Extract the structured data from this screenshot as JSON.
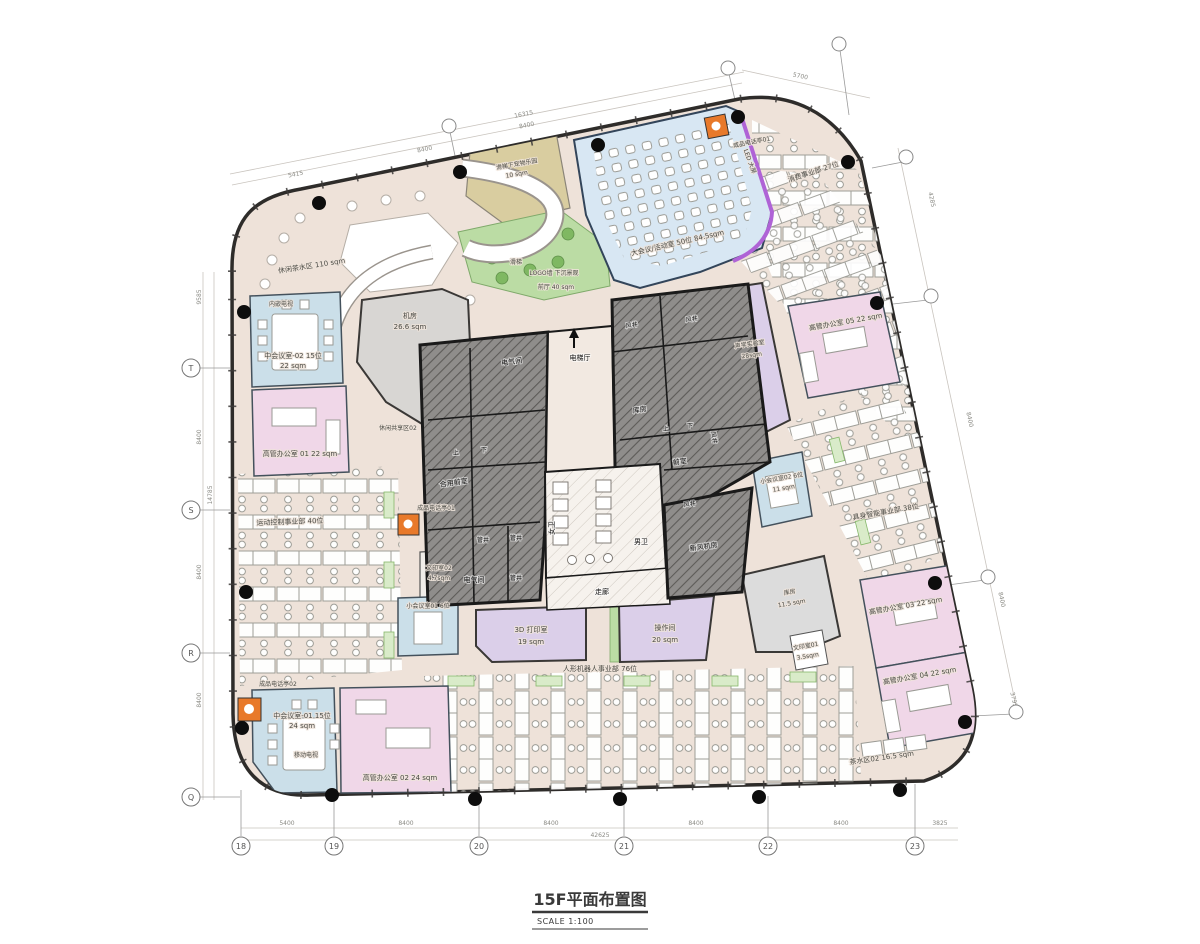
{
  "title": {
    "main": "15F平面布置图",
    "scale": "SCALE 1:100"
  },
  "grid": {
    "left": [
      "T",
      "S",
      "R",
      "Q"
    ],
    "bottom": [
      "18",
      "19",
      "20",
      "21",
      "22",
      "23"
    ]
  },
  "dims": {
    "top": [
      "5415",
      "8400",
      "16315",
      "8400",
      "5700"
    ],
    "left": [
      "9585",
      "8400",
      "14785",
      "8400",
      "8400"
    ],
    "right": [
      "4285",
      "8400",
      "8400",
      "3795"
    ],
    "bottom": [
      "5400",
      "8400",
      "8400",
      "8400",
      "8400",
      "3825",
      "42625"
    ]
  },
  "rooms": {
    "lounge_tea": "休闲茶水区 110 sqm",
    "pet_park": [
      "滑梯下宠物乐园",
      "10 sqm"
    ],
    "slide": "滑梯",
    "logo_wall": "LOGO墙 下沉景观",
    "front_hall": "前厅 40 sqm",
    "big_meeting": "大会议/活动室 50位 84.5sqm",
    "led_screen": "LED 大屏",
    "phone_booth_01a": "成品电话亭01",
    "consumer_dept": "消费事业部 27位",
    "embed_tv": "内嵌电视",
    "mid_meeting_02": [
      "中会议室-02 15位",
      "22 sqm"
    ],
    "exec_office_01": "高管办公室 01 22 sqm",
    "machine_room": [
      "机房",
      "26.6 sqm"
    ],
    "leisure_share_02": "休闲共享区02",
    "motion_dept": "运动控制事业部 40位",
    "phone_booth_01b": "成品电话亭01",
    "print_room_02": [
      "文印室02",
      "4.7sqm"
    ],
    "small_meeting_01": "小会议室01 6位",
    "print_3d": [
      "3D 打印室",
      "19 sqm"
    ],
    "humanoid_dept": "人形机器人事业部 76位",
    "operation_room": [
      "操作间",
      "20 sqm"
    ],
    "storage_south": [
      "库房",
      "11.5 sqm"
    ],
    "print_room_01": [
      "文印室01",
      "3.5sqm"
    ],
    "acoustic_lab": [
      "声学实验室",
      "28sqm"
    ],
    "exec_office_05": "高管办公室 05 22 sqm",
    "embodied_dept": "具身智能事业部 38位",
    "small_meeting_02": [
      "小会议室02 6位",
      "11 sqm"
    ],
    "exec_office_03": "高管办公室 03 22 sqm",
    "exec_office_04": "高管办公室 04 22 sqm",
    "tea_area_02": "茶水区02 16.5 sqm",
    "phone_booth_02": "成品电话亭02",
    "mid_meeting_01": [
      "中会议室-01 15位",
      "24 sqm"
    ],
    "mobile_tv": "移动电视",
    "exec_office_02": "高管办公室 02 24 sqm"
  },
  "core": {
    "elec_room": "电气间",
    "elevator_hall": "电梯厅",
    "wind_shaft": "风井",
    "storage": "库房",
    "anteroom": "前室",
    "shared_anteroom": "合用前室",
    "pipe_shaft": "管井",
    "women_wc": "女卫",
    "men_wc": "男卫",
    "corridor": "走廊",
    "fresh_air_room": "新风机房",
    "up": "上",
    "down": "下"
  },
  "colors": {
    "floor": "#EEE2D9",
    "meeting_blue": "#CBDFE9",
    "big_meeting_blue": "#D8E7F3",
    "office_pink": "#F0D7E8",
    "utility_purple": "#DBCFE9",
    "landscape_green": "#BBDCA4",
    "pet_tan": "#D9CDA0",
    "phone_booth_orange": "#E8792A",
    "led_purple": "#AF63D6",
    "core_gray": "#8F8D8B"
  }
}
